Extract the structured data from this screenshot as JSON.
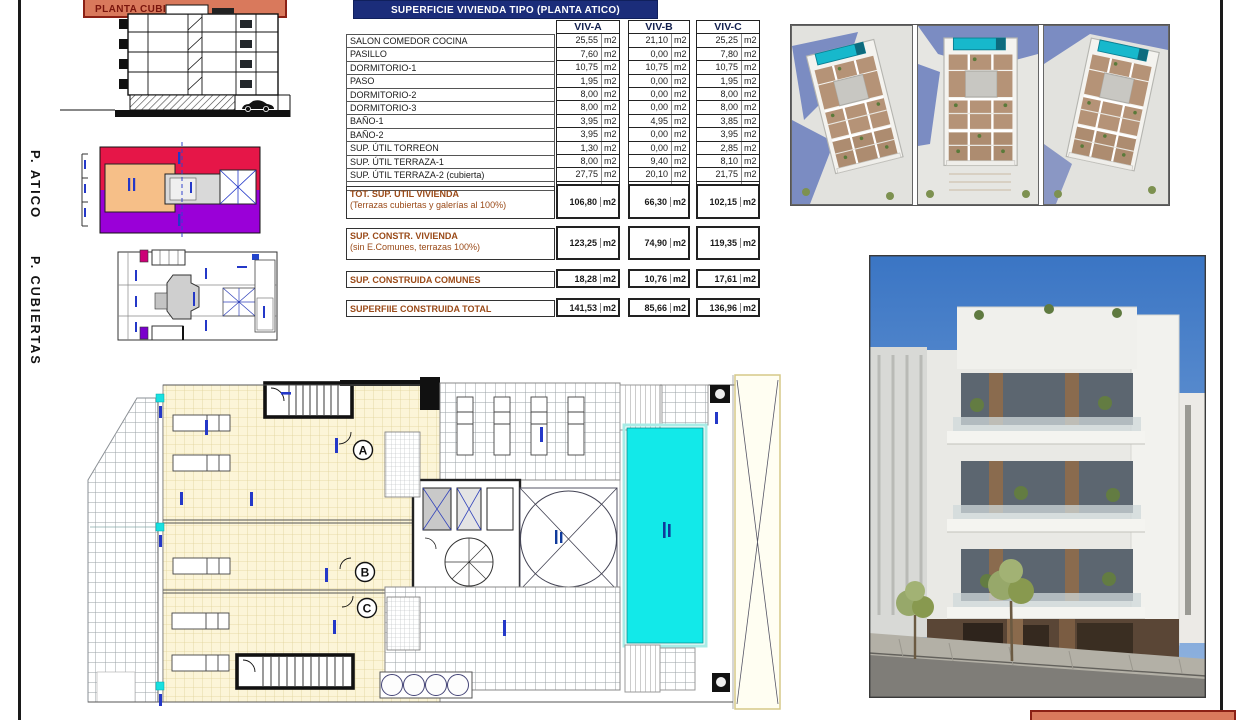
{
  "labels": {
    "planta_cubierta": "PLANTA CUBIERTA",
    "p_atico": "P. ATICO",
    "p_cubiertas": "P. CUBIERTAS"
  },
  "table": {
    "title": "SUPERFICIE VIVIENDA TIPO  (PLANTA ATICO)",
    "unit": "m2",
    "columns": [
      "VIV-A",
      "VIV-B",
      "VIV-C"
    ],
    "rows": [
      {
        "label": "SALON COMEDOR COCINA",
        "values": [
          "25,55",
          "21,10",
          "25,25"
        ]
      },
      {
        "label": "PASILLO",
        "values": [
          "7,60",
          "0,00",
          "7,80"
        ]
      },
      {
        "label": "DORMITORIO-1",
        "values": [
          "10,75",
          "10,75",
          "10,75"
        ]
      },
      {
        "label": "PASO",
        "values": [
          "1,95",
          "0,00",
          "1,95"
        ]
      },
      {
        "label": "DORMITORIO-2",
        "values": [
          "8,00",
          "0,00",
          "8,00"
        ]
      },
      {
        "label": "DORMITORIO-3",
        "values": [
          "8,00",
          "0,00",
          "8,00"
        ]
      },
      {
        "label": "BAÑO-1",
        "values": [
          "3,95",
          "4,95",
          "3,85"
        ]
      },
      {
        "label": "BAÑO-2",
        "values": [
          "3,95",
          "0,00",
          "3,95"
        ]
      },
      {
        "label": "SUP. ÚTIL TORREON",
        "values": [
          "1,30",
          "0,00",
          "2,85"
        ]
      },
      {
        "label": "SUP. ÚTIL TERRAZA-1",
        "values": [
          "8,00",
          "9,40",
          "8,10"
        ]
      },
      {
        "label": "SUP. ÚTIL TERRAZA-2 (cubierta)",
        "values": [
          "27,75",
          "20,10",
          "21,75"
        ]
      }
    ],
    "summary_rows": [
      {
        "label": "TOT. SUP. UTIL VIVIENDA",
        "sublabel": "(Terrazas cubiertas y galerías al 100%)",
        "values": [
          "106,80",
          "66,30",
          "102,15"
        ]
      },
      {
        "label": "SUP. CONSTR. VIVIENDA",
        "sublabel": "(sin E.Comunes, terrazas 100%)",
        "values": [
          "123,25",
          "74,90",
          "119,35"
        ]
      },
      {
        "label": "SUP. CONSTRUIDA COMUNES",
        "sublabel": "",
        "values": [
          "18,28",
          "10,76",
          "17,61"
        ]
      },
      {
        "label": "SUPERFIIE CONSTRUIDA TOTAL",
        "sublabel": "",
        "values": [
          "141,53",
          "85,66",
          "136,96"
        ]
      }
    ]
  },
  "floor_plan": {
    "unit_letters": [
      "A",
      "B",
      "C"
    ]
  },
  "colors": {
    "table_header_navy": "#1b2d7a",
    "summary_brown": "#9a4a18",
    "banner_salmon": "#d9795c",
    "banner_maroon": "#8b2015",
    "atico_red": "#e61648",
    "atico_purple": "#9a00d8",
    "atico_orange": "#f6bf88",
    "pool_cyan": "#12e9e9",
    "tile_cream": "#fcf5d8"
  }
}
